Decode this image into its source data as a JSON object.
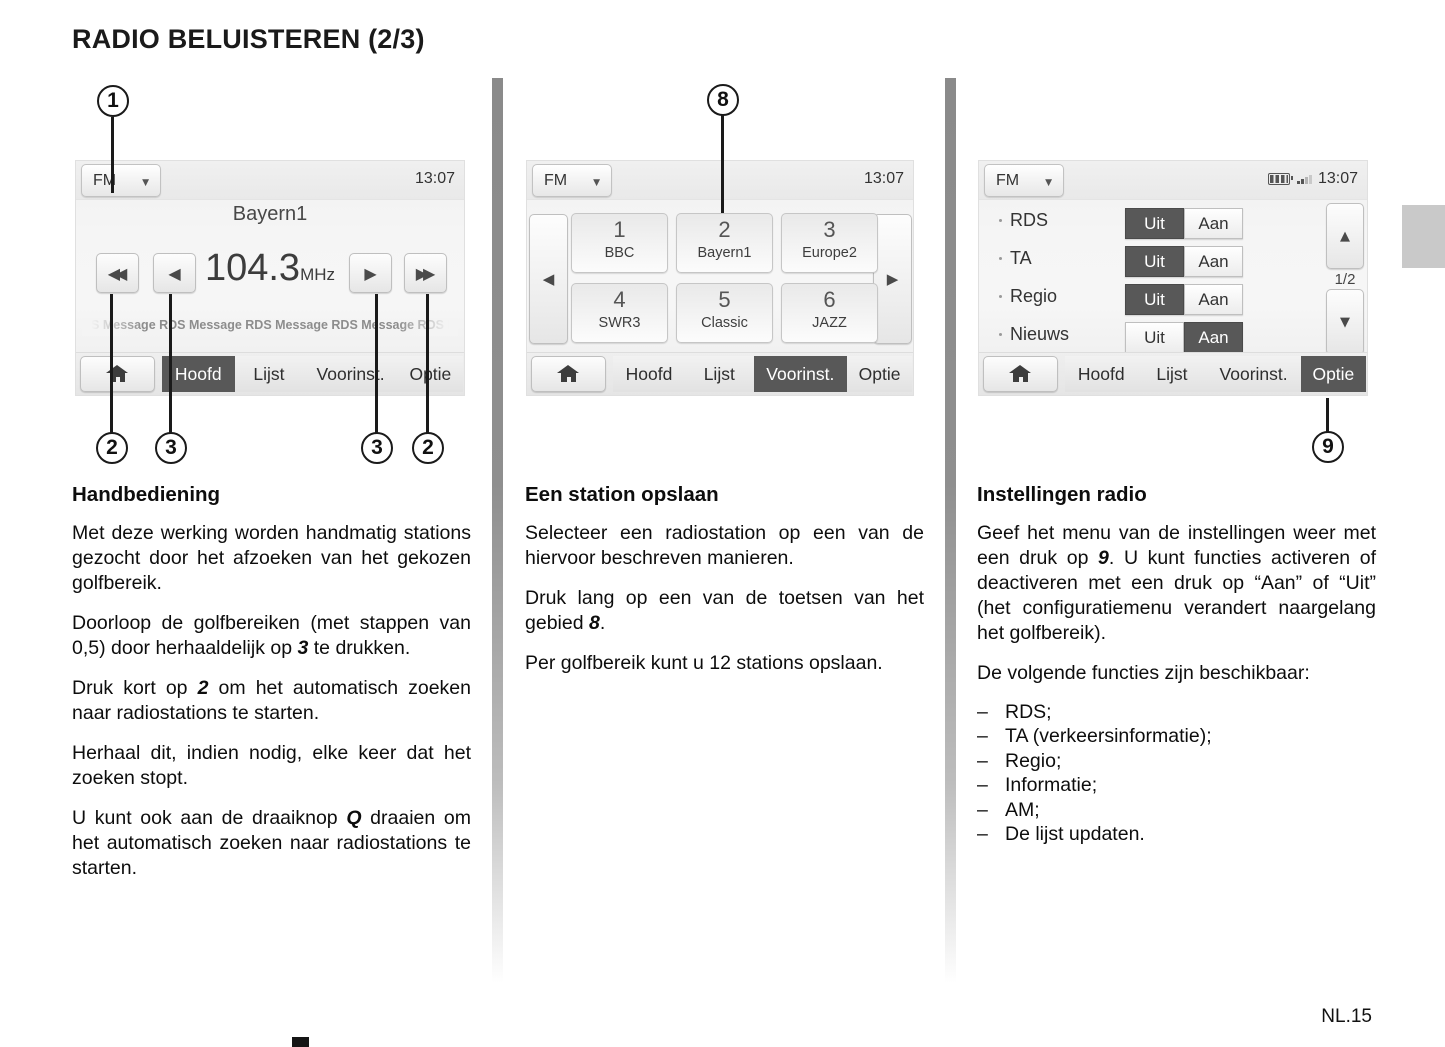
{
  "page": {
    "title": "RADIO BELUISTEREN (2/3)",
    "page_number": "NL.15"
  },
  "radio": {
    "band": "FM",
    "time": "13:07",
    "tabs": [
      "Hoofd",
      "Lijst",
      "Voorinst.",
      "Optie"
    ],
    "toggle_off": "Uit",
    "toggle_on": "Aan"
  },
  "screen1": {
    "station": "Bayern1",
    "frequency": "104.3",
    "frequency_unit": "MHz",
    "ticker": "DS Message RDS Message RDS Message RDS Message RDS Message",
    "selected_tab": "Hoofd"
  },
  "screen2": {
    "presets": [
      {
        "num": "1",
        "name": "BBC"
      },
      {
        "num": "2",
        "name": "Bayern1"
      },
      {
        "num": "3",
        "name": "Europe2"
      },
      {
        "num": "4",
        "name": "SWR3"
      },
      {
        "num": "5",
        "name": "Classic"
      },
      {
        "num": "6",
        "name": "JAZZ"
      }
    ],
    "selected_tab": "Voorinst."
  },
  "screen3": {
    "settings": [
      {
        "label": "RDS",
        "selected": "Uit"
      },
      {
        "label": "TA",
        "selected": "Uit"
      },
      {
        "label": "Regio",
        "selected": "Uit"
      },
      {
        "label": "Nieuws",
        "selected": "Aan"
      }
    ],
    "page_indicator": "1/2",
    "selected_tab": "Optie"
  },
  "callouts": {
    "n1": "1",
    "n2": "2",
    "n3": "3",
    "n8": "8",
    "n9": "9"
  },
  "icons": [
    "chevron-down-icon",
    "rewind-icon",
    "step-back-icon",
    "step-forward-icon",
    "fast-forward-icon",
    "home-icon",
    "chevron-left-icon",
    "chevron-right-icon",
    "arrow-up-icon",
    "arrow-down-icon",
    "battery-icon",
    "signal-icon"
  ],
  "colors": {
    "selected_dark": "#585858",
    "divider_gray": "#8a8a8a"
  },
  "sections": {
    "col1": {
      "heading": "Handbediening",
      "paragraphs": [
        [
          {
            "t": "Met deze werking worden handmatig stati­ons gezocht door het afzoeken van het ge­kozen golfbereik."
          }
        ],
        [
          {
            "t": "Doorloop de golfbereiken (met stappen van 0,5) door herhaaldelijk op "
          },
          {
            "t": "3",
            "b": true
          },
          {
            "t": " te drukken."
          }
        ],
        [
          {
            "t": "Druk kort op "
          },
          {
            "t": "2",
            "b": true
          },
          {
            "t": " om het automatisch zoeken naar radiostations te starten."
          }
        ],
        [
          {
            "t": "Herhaal dit, indien nodig, elke keer dat het zoeken stopt."
          }
        ],
        [
          {
            "t": "U kunt ook aan de draaiknop "
          },
          {
            "t": "Q",
            "b": true
          },
          {
            "t": " draaien om het automatisch zoeken naar radiostations te starten."
          }
        ]
      ]
    },
    "col2": {
      "heading": "Een station opslaan",
      "paragraphs": [
        [
          {
            "t": "Selecteer een radiostation op een van de hiervoor beschreven manieren."
          }
        ],
        [
          {
            "t": "Druk lang op een van de toetsen van het gebied "
          },
          {
            "t": "8",
            "b": true
          },
          {
            "t": "."
          }
        ],
        [
          {
            "t": "Per golfbereik kunt u 12 stations opslaan."
          }
        ]
      ]
    },
    "col3": {
      "heading": "Instellingen radio",
      "paragraphs": [
        [
          {
            "t": "Geef het menu van de instellingen weer met een druk op "
          },
          {
            "t": "9",
            "b": true
          },
          {
            "t": ". U kunt functies activeren of deactiveren met een druk op “Aan” of “Uit” (het configuratiemenu verandert naargelang het golfbereik)."
          }
        ],
        [
          {
            "t": "De volgende functies zijn beschikbaar:"
          }
        ]
      ],
      "list_dash": "–",
      "list": [
        "RDS;",
        "TA (verkeersinformatie);",
        "Regio;",
        "Informatie;",
        "AM;",
        "De lijst updaten."
      ]
    }
  }
}
